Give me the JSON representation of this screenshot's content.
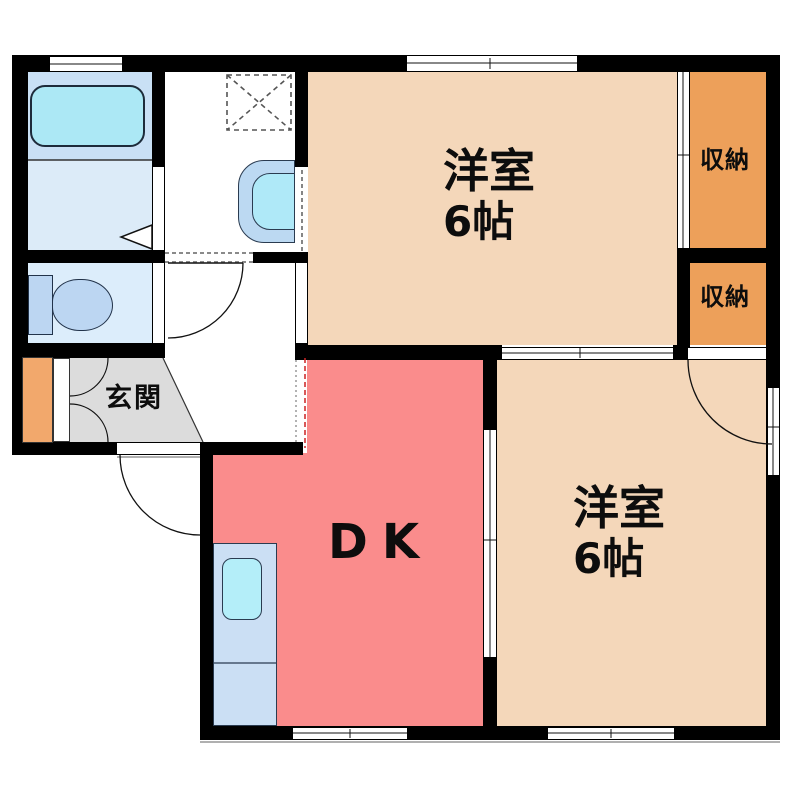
{
  "plan": {
    "type": "apartment-floor-plan",
    "rooms": {
      "bedroom_top": {
        "label": "洋室",
        "size": "6帖"
      },
      "bedroom_bottom": {
        "label": "洋室",
        "size": "6帖"
      },
      "dk": {
        "label": "DK"
      },
      "entrance": {
        "label": "玄関"
      },
      "closet_top": {
        "label": "収納"
      },
      "closet_bottom": {
        "label": "収納"
      }
    },
    "fixtures": [
      "bathtub-icon",
      "washing-machine-pan-icon",
      "wash-basin-icon",
      "toilet-icon",
      "shoe-cabinet-icon",
      "kitchen-sink-icon"
    ],
    "symbols": [
      "door-swing-arc",
      "sliding-door",
      "window",
      "folding-bath-door",
      "open-boundary-dashed-line"
    ],
    "colors": {
      "wall": "#000000",
      "bedroom_fill": "#F4D7BA",
      "closet_fill": "#EDA05A",
      "dk_fill": "#FA8C8C",
      "entrance_fill": "#DCDCDC",
      "bath_fill": "#C9E0F5",
      "washroom_fill": "#DCEBF8",
      "toilet_room_fill": "#DCEDFB",
      "fixture_blue": "#BCD6F2",
      "water_cyan": "#ACE8F5",
      "kitchen_fill": "#CBDFF4",
      "shoe_cabinet_fill": "#F2A86C",
      "open_boundary_red": "#CC2222"
    }
  }
}
